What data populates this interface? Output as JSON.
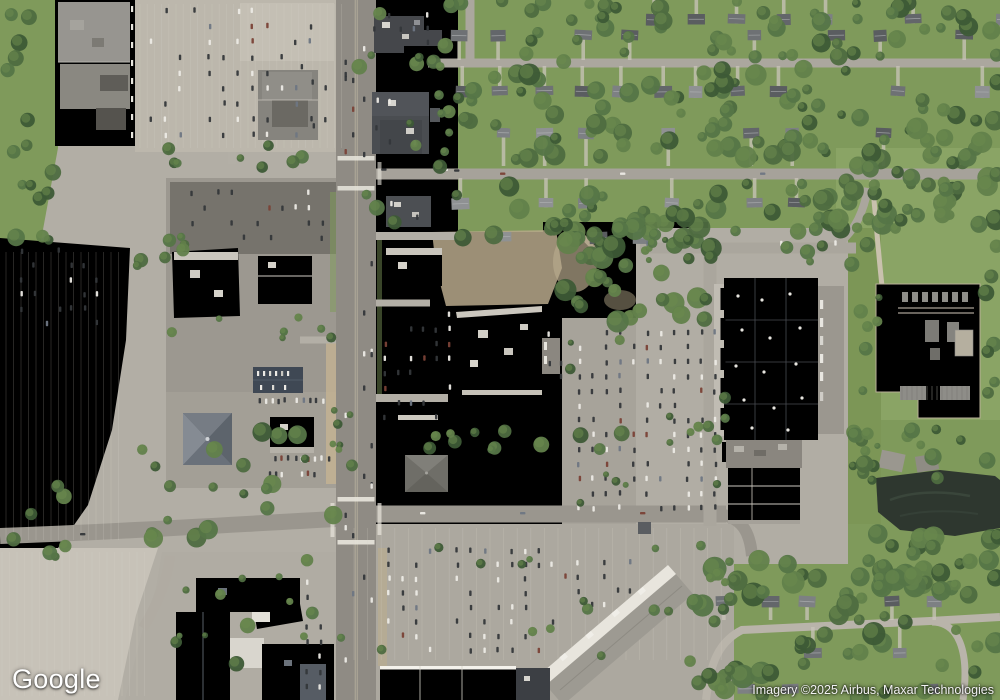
{
  "map": {
    "view_type": "satellite",
    "provider_logo_text": "Google",
    "attribution_text": "Imagery ©2025 Airbus, Maxar Technologies"
  },
  "colors": {
    "grass": "#7f9a5b",
    "grass_light": "#95a966",
    "field": "#8aa465",
    "tree_dark": "#3d5a36",
    "tree_mid": "#4e6c40",
    "pavement_light": "#c6c1b6",
    "pavement_mid": "#b2aea5",
    "pavement_dark": "#9e9a92",
    "road": "#8f8b84",
    "road_minor": "#a5a198",
    "dirt": "#b7a88b",
    "building_white": "#ebe8e1",
    "building_gray": "#8f8d86",
    "roof_dark": "#3d4045",
    "roof_slate": "#464c54",
    "orange_accent": "#e07a3c",
    "substation_pad": "#d2cab5",
    "pond": "#2e372f",
    "car_dark": "#34373a",
    "car_white": "#eceae5",
    "line_white": "#d8d4ca",
    "logo_text": "#ffffff",
    "attribution_text": "#f2f2f2"
  },
  "features": [
    "mall-anchor-store",
    "mall-parking-lot",
    "main-arterial-road",
    "residential-neighborhood-north",
    "vacant-overgrown-parcel",
    "center-retail-anchor",
    "big-box-store-orange-accent",
    "electrical-substation",
    "retention-pond",
    "strip-mall",
    "hotel-complex",
    "south-shopping-plaza",
    "residential-neighborhood-south"
  ]
}
